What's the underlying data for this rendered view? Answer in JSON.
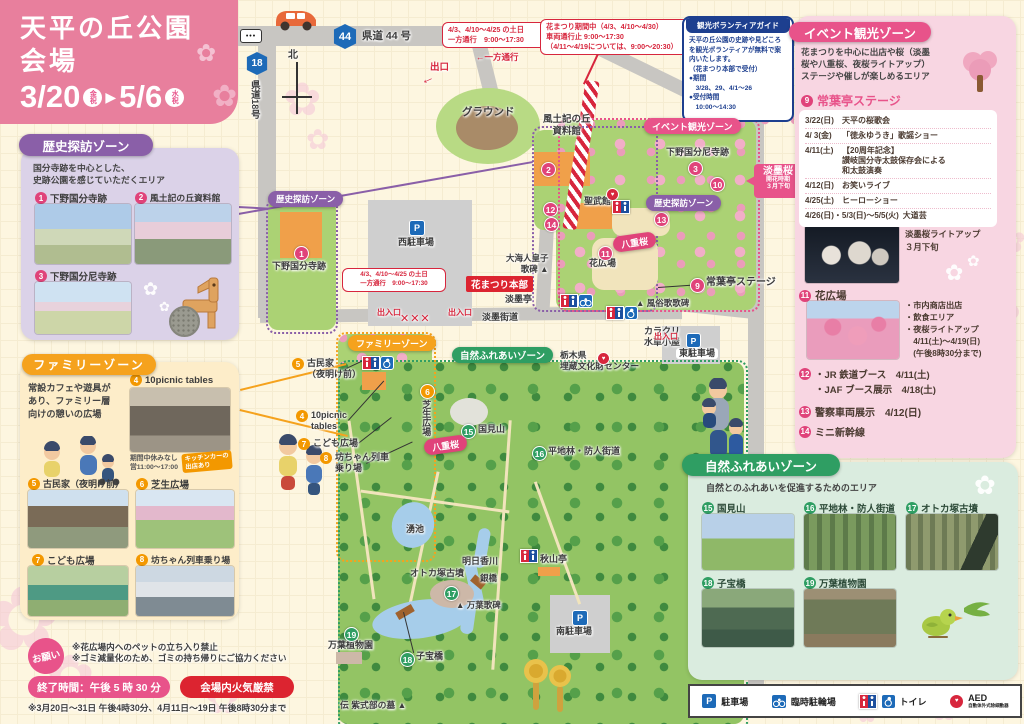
{
  "header": {
    "title": "天平の丘公園\n会場",
    "date_start": "3/20",
    "date_start_badge": "金祝",
    "arrow": "▶",
    "date_end": "5/6",
    "date_end_badge": "水祝"
  },
  "notices": {
    "oneway_weekend": "4/3、4/10～4/25 の土日\n一方通行　9:00～17:30",
    "closure": "花まつり期間中（4/3、4/10～4/30）\n車両通行止 9:00～17:30\n（4/11～4/19については、9:00～20:30）",
    "volunteer": {
      "title": "観光ボランティアガイド",
      "body": "天平の丘公園の史跡や見どころを観光ボランティアが無料で案内いたします。\n（花まつり本部で受付）\n●期間\n　3/28、29、4/1～26\n●受付時間\n　10:00～14:30"
    },
    "requests": {
      "badge": "お願い",
      "lines": "※花広場内へのペットの立ち入り禁止\n※ゴミ減量化のため、ゴミの持ち帰りにご協力ください",
      "end_time": "終了時間：午後 5 時 30 分",
      "fire_ban": "会場内火気厳禁",
      "footnote": "※3月20日～31日 午後4時30分、4月11日～19日 午後8時30分まで"
    }
  },
  "zones": {
    "history": {
      "title": "歴史探訪ゾーン",
      "description": "国分寺跡を中心とした、\n史跡公園を感じていただくエリア",
      "items": [
        {
          "num": "1",
          "label": "下野国分寺跡"
        },
        {
          "num": "2",
          "label": "風土記の丘資料館"
        },
        {
          "num": "3",
          "label": "下野国分尼寺跡"
        }
      ]
    },
    "family": {
      "title": "ファミリーゾーン",
      "description": "常設カフェや遊具が\nあり、ファミリー層\n向けの憩いの広場",
      "items": [
        {
          "num": "4",
          "label": "10picnic tables",
          "note": "期間中休みなし\n営11:00～17:00",
          "tag": "キッチンカーの\n出店あり"
        },
        {
          "num": "5",
          "label": "古民家（夜明け前）"
        },
        {
          "num": "6",
          "label": "芝生広場"
        },
        {
          "num": "7",
          "label": "こども広場"
        },
        {
          "num": "8",
          "label": "坊ちゃん列車乗り場"
        }
      ]
    },
    "event": {
      "title": "イベント観光ゾーン",
      "description": "花まつりを中心に出店や桜（淡墨\n桜や八重桜、夜桜ライトアップ）\nステージや催しが楽しめるエリア",
      "stage": {
        "num": "9",
        "label": "常葉亭ステージ",
        "schedule": [
          {
            "date": "3/22(日)",
            "event": "天平の桜歌会"
          },
          {
            "date": "4/ 3(金)",
            "event": "「徳永ゆうき」歌謡ショー"
          },
          {
            "date": "4/11(土)",
            "event": "【20周年記念】\n讃岐国分寺太鼓保存会による\n和太鼓演奏"
          },
          {
            "date": "4/12(日)",
            "event": "お笑いライブ"
          },
          {
            "date": "4/25(土)",
            "event": "ヒーローショー"
          },
          {
            "date": "4/26(日)・5/3(日)～5/5(火)",
            "event": "大道芸"
          }
        ]
      },
      "usuzumi": {
        "num": "10",
        "label": "淡墨桜",
        "note": "淡墨桜ライトアップ\n３月下旬"
      },
      "flower_plaza": {
        "num": "11",
        "label": "花広場",
        "notes": "・市内商店出店\n・飲食エリア\n・夜桜ライトアップ\n　4/11(土)～4/19(日)\n　(午後8時30分まで)"
      },
      "booths": {
        "num": "12",
        "lines": "・JR 鉄道ブース　4/11(土)\n・JAF ブース展示　4/18(土)"
      },
      "police": {
        "num": "13",
        "label": "警察車両展示　4/12(日)"
      },
      "shinkansen": {
        "num": "14",
        "label": "ミニ新幹線"
      }
    },
    "nature": {
      "title": "自然ふれあいゾーン",
      "description": "自然とのふれあいを促進するためのエリア",
      "items": [
        {
          "num": "15",
          "label": "国見山"
        },
        {
          "num": "16",
          "label": "平地林・防人街道"
        },
        {
          "num": "17",
          "label": "オトカ塚古墳"
        },
        {
          "num": "18",
          "label": "子宝橋"
        },
        {
          "num": "19",
          "label": "万葉植物園"
        }
      ]
    }
  },
  "map": {
    "icons": {
      "p": "P"
    },
    "roads": {
      "route44_num": "44",
      "route44": "県道 44 号",
      "route18_num": "18",
      "route18": "県道18号",
      "north": "北"
    },
    "labels": {
      "exit_top": "出口",
      "exit_arrow": "←",
      "oneway_arrow": "←一方通行",
      "ground": "グラウンド",
      "fudoki": "風土記の丘\n資料館",
      "event_pill": "イベント観光ゾーン",
      "nijidera": "下野国分尼寺跡",
      "usuzumi_title": "淡墨桜",
      "usuzumi_sub": "開花時期\n３月下旬",
      "seibukan": "聖武館",
      "history_pill": "歴史探訪ゾーン",
      "yaezakura": "八重桜",
      "hanahiroba": "花広場",
      "oama": "大海人皇子\n歌碑 ▲",
      "honbu": "花まつり本部",
      "usuzumitei": "淡墨亭",
      "stage": "常葉亭ステージ",
      "fuzoku": "▲ 風俗歌歌碑",
      "kaido": "淡墨街道",
      "west_parking": "西駐車場",
      "kokubunji": "下野国分寺跡",
      "gate": "出入口",
      "barrier": "✕✕✕",
      "family_pill": "ファミリーゾーン",
      "nature_pill": "自然ふれあいゾーン",
      "karakuri": "カラクリ\n水車小屋",
      "maizo": "栃木県\n埋蔵文化財センター",
      "east_parking": "東駐車場",
      "shibafu": "芝生広場",
      "kunimi": "国見山",
      "heichirin": "平地林・防人街道",
      "wakiike": "湧池",
      "asukagawa": "明日香川",
      "ginbashi": "銀橋",
      "otoka": "オトカ塚古墳",
      "manyokahi": "▲ 万葉歌碑",
      "akiyamatei": "秋山亭",
      "manyo_garden": "万葉植物園",
      "kodakara": "子宝橋",
      "south_parking": "南駐車場",
      "murasaki": "伝 紫式部の墓 ▲",
      "co_kominka": "古民家\n（夜明け前）",
      "co_picnic": "10picnic\ntables",
      "co_kodomo": "こども広場",
      "co_bochan": "坊ちゃん列車\n乗り場"
    }
  },
  "legend": {
    "parking": "駐車場",
    "bicycle": "臨時駐輪場",
    "toilet": "トイレ",
    "aed": "AED",
    "aed_sub": "自動体外式除細動器"
  }
}
